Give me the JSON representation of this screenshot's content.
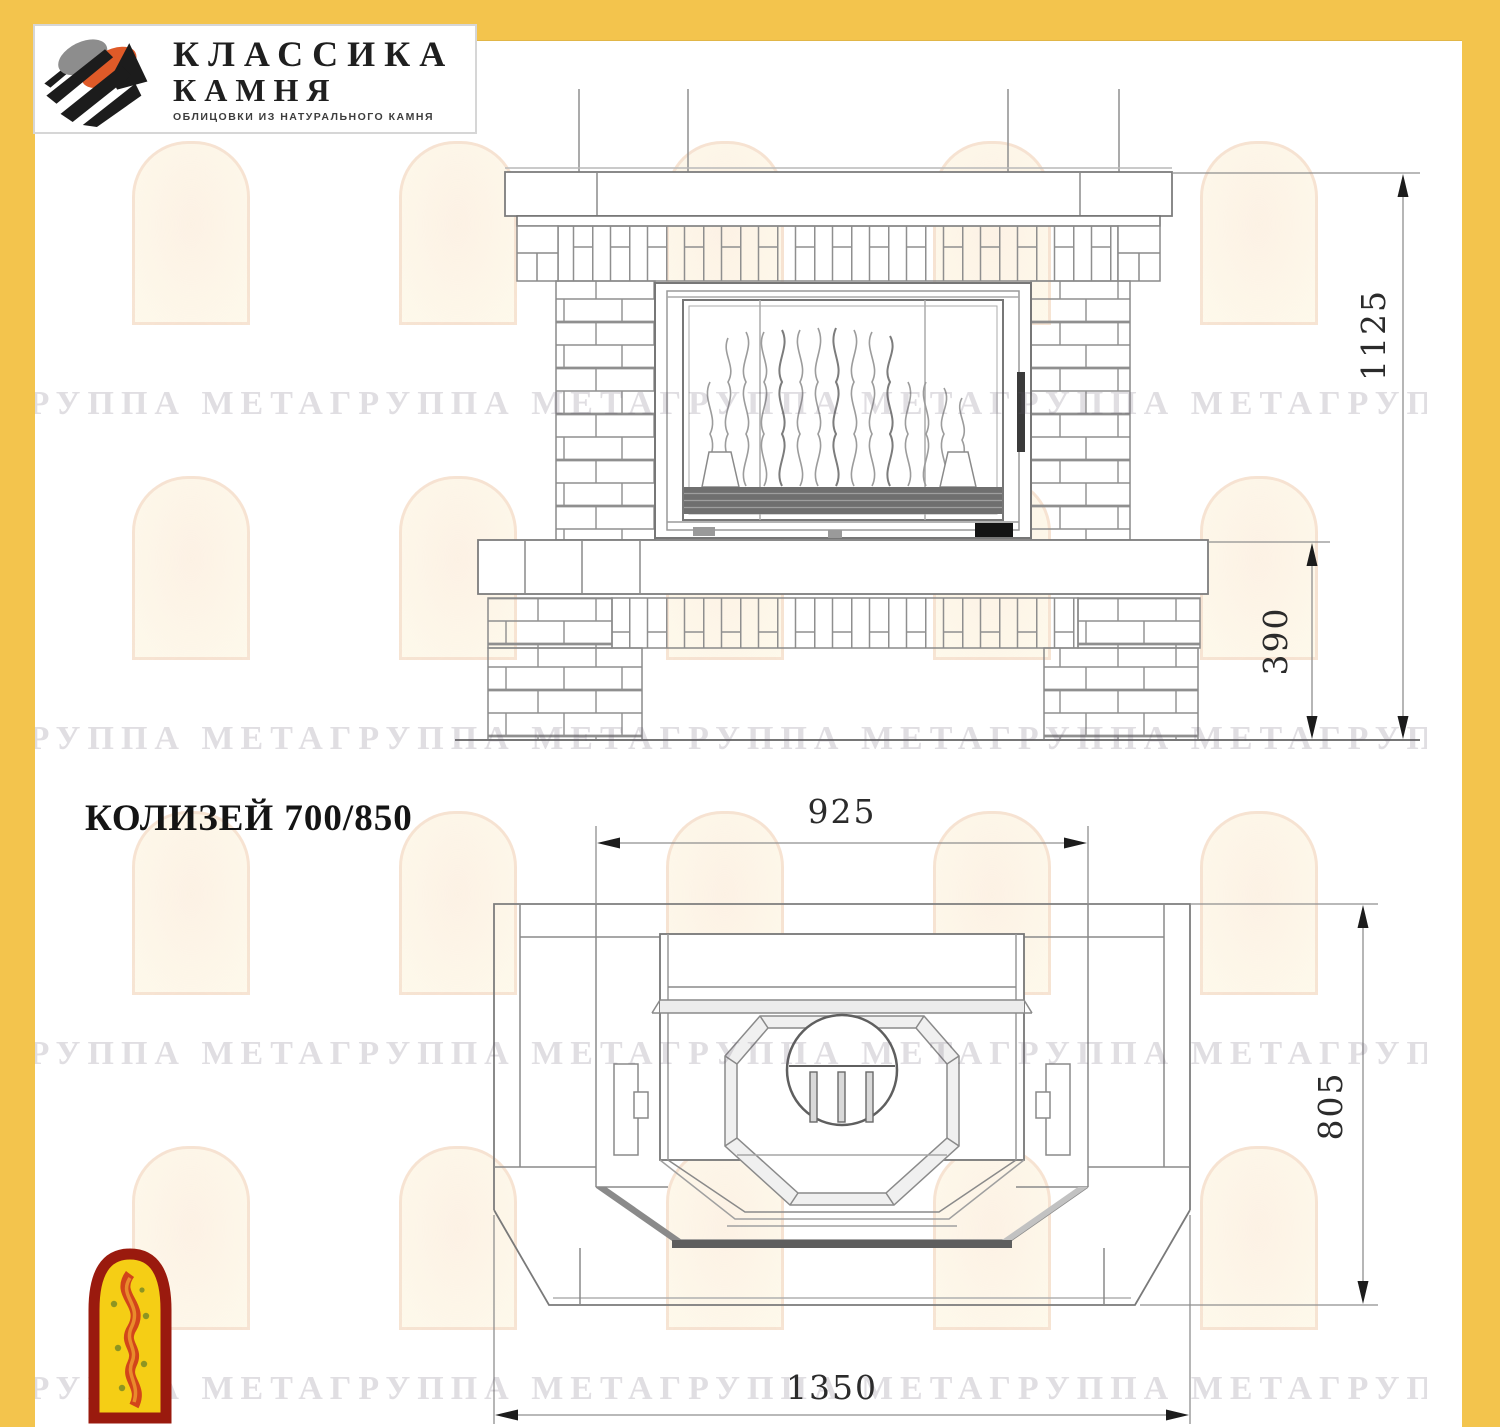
{
  "page": {
    "background": "#ffffff",
    "frame_color": "#F3C44D"
  },
  "logo": {
    "name_line1": "КЛАССИКА",
    "name_line2": "КАМНЯ",
    "tagline": "ОБЛИЦОВКИ ИЗ НАТУРАЛЬНОГО КАМНЯ",
    "icon": "stone-slabs-logo-icon",
    "colors": {
      "orange": "#DF5A28",
      "gray": "#8D8D8D",
      "black": "#1C1C1C"
    }
  },
  "title": "КОЛИЗЕЙ 700/850",
  "watermark": {
    "text": "ГРУППА МЕТАГРУППА МЕТАГРУППА МЕТАГРУППА МЕТАГРУППА МЕТАГРУППА",
    "arch_icon": "arch-flame-watermark-icon"
  },
  "drawings": {
    "front_elevation": {
      "description": "fireplace front elevation with brick portal, firebox with flames, mantel shelf and hearth",
      "dimensions": {
        "total_height": "1125",
        "hearth_height": "390"
      }
    },
    "plan_view": {
      "description": "fireplace top plan view with octagonal insert, flue circle and chamfered base",
      "dimensions": {
        "firebox_width": "925",
        "depth": "805",
        "total_width": "1350"
      }
    }
  },
  "footer_logo": {
    "icon": "arch-flame-logo-icon",
    "colors": {
      "border": "#9A1A0E",
      "fill": "#F5CE15",
      "flame": "#D2451A",
      "dots": "#7C8C25"
    }
  }
}
